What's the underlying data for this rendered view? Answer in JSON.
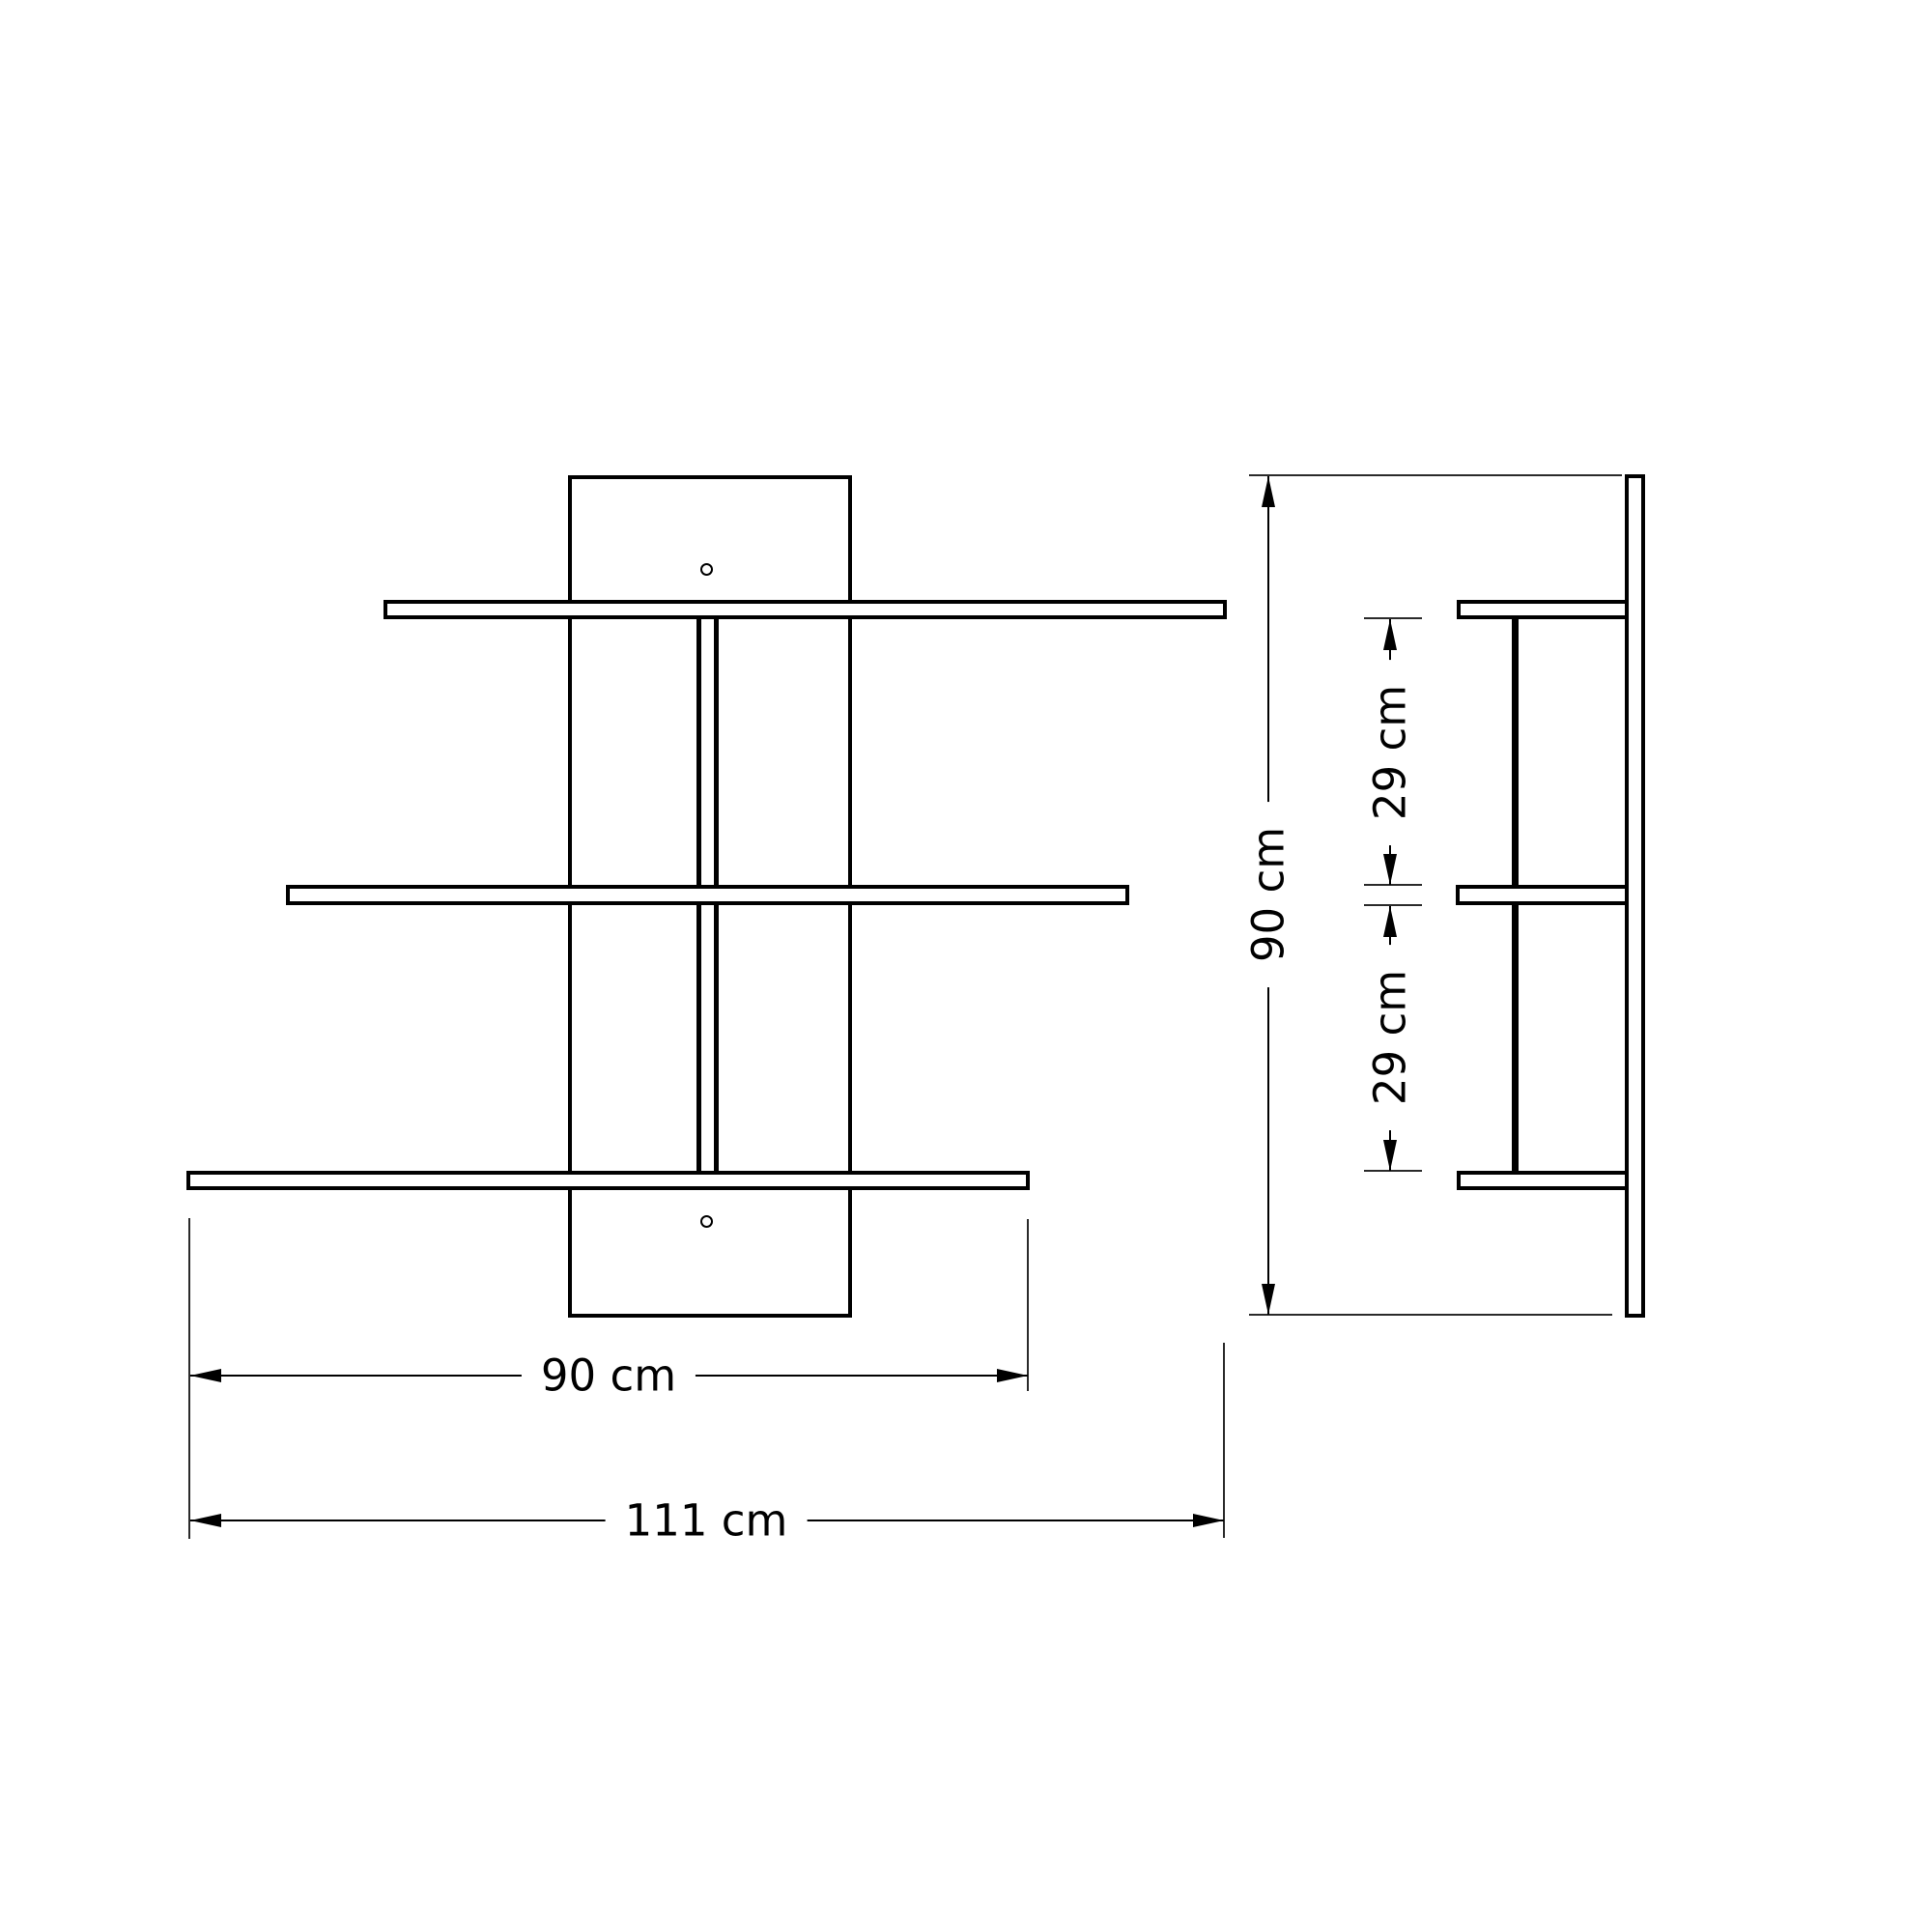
{
  "colors": {
    "background": "#ffffff",
    "line": "#000000"
  },
  "dimensions": {
    "height": "90 cm",
    "gap_upper": "29 cm",
    "gap_lower": "29 cm",
    "shelf_width": "90 cm",
    "total_width": "111 cm"
  }
}
